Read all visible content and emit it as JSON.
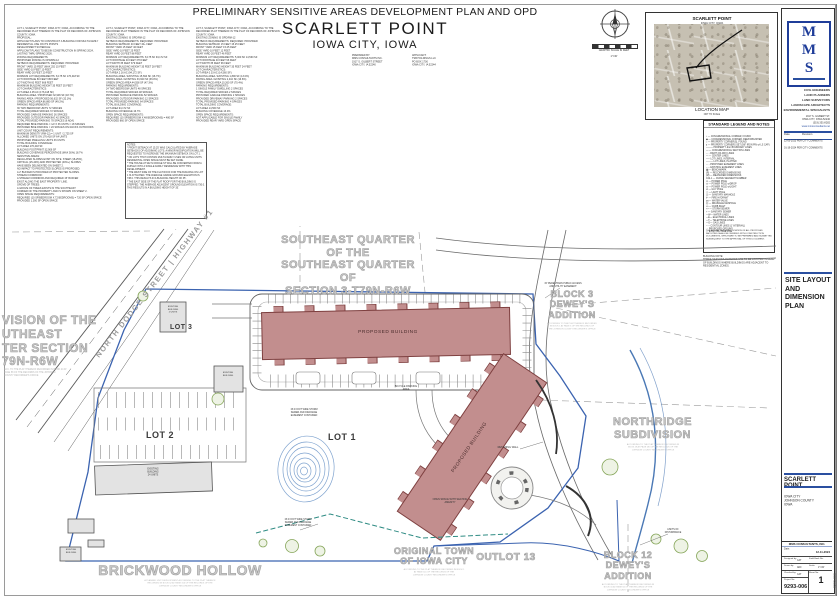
{
  "sheet": {
    "main_title": "PRELIMINARY SENSITIVE AREAS DEVELOPMENT PLAN AND OPD",
    "project_name": "SCARLETT POINT",
    "project_city": "IOWA CITY, IOWA"
  },
  "header": {
    "legal_block_1": "LOT 1, SCARLETT POINT, IOWA CITY, IOWA, ACCORDING TO THE RECORDED PLAT THEREOF IN THE PLAT OF RECORDS OF JOHNSON COUNTY, IOWA.\nPROPOSAL:\nAPPLICANT PLANS TO CONSTRUCT A BUILDING FOR MULTI-FAMILY RESIDENTIAL USE ON ITS POINTS\nDEVELOPMENT SCHEDULE:\nAPPLICANT PLANS TO BEGIN CONSTRUCTION IN SPRING 2024, LASTING THRU SPRING 2026.\nZONING REQUIREMENTS:\nPROPOSED ZONING IS OPD/RM-12\nSETBACK REQUIREMENTS:   REQUIRED:   PROVIDED:\nFRONT YARD   15 FEET (MAX 25')   15 FEET\nSIDE YARD   10 FEET   10 FEET\nREAR YARD   20 FEET   20 FEET\nMINIMUM LOT REQUIREMENTS:   8,175 SF   176,418 SF\nLOT FRONTAGE   80 FEET   668 FEET\nLOT WIDTH   60 FEET   668 FEET\nMAXIMUM BUILDING HEIGHT   35 FEET   35 FEET\nLOT CHARACTERISTICS:\nLOT AREA   4.05 AC (176,418 SF)\nBUILDING AREA / PROPOSED   32,906 SF (18.7%)\nPAVING AREA / PROPOSED   56,632 SF (32.1%)\nGREEN SPACE AREA   86,880 SF (49.2%)\nPARKING REQUIREMENTS:\n36 TWO BEDROOM UNITS   72 SPACES\nTOTAL REQUIRED SPACES   72 SPACES\nPROVIDED GARAGE PARKING   36 SPACES\nPROVIDED OUTDOOR PARKING   42 SPACES\nTOTAL PROVIDED PARKING   78 SPACES (6 ADA)\nREQUIRED BIKE PARKING = 1/2 X 36 UNITS = 18 SPACES\nPROVIDED BIKE PARKING = 20 SPACES ON RACKS OUTDOORS\nUNIT COUNT REQUIREMENTS:\nMAXIMUM DENSITY (RM-12) = 1 UNIT / 2,725 SF\nALLOWED UNITS ON 176,418 SF   64 UNITS\nPROPOSED DWELLING UNITS   36 UNITS\nTOTAL BUILDING COVERAGE:\nLOT AREA   176,418 SF\nBUILDING FOOTPRINT   32,906 SF\nBUILDING COVERAGE PERCENTAGE (MAX 50%)   18.7%\nSENSITIVE AREAS:\nREGULATED SLOPES EXIST ON SITE. STEEP (18-25%),\nCRITICAL (25-40%) AND PROTECTED (40%+) SLOPES\nHAVE BEEN DELINEATED ON SHEET 2.\nNO IMPACT TO PROTECTED SLOPES IS PROPOSED.\nA 2' BUFFER IS PROVIDED AT PROTECTED SLOPES.\nSTREAM CORRIDOR:\nA STREAM CORRIDOR AND REQUIRED 15' BUFFER\nEXIST ALONG THE EAST PROPERTY LINE.\nGROVE OF TREES:\nA GROVE OF TREES EXISTS IN THE SOUTHEAST\nCORNER OF THE PROPERTY AND IS SHOWN ON SHEET 2.\nOPEN SPACE REQUIREMENTS:\nREQUIRED (10 SF/BEDROOM X 72 BEDROOMS) = 720 SF OPEN SPACE\nPROVIDED   1,300 SF OPEN SPACE",
    "legal_block_2": "LOT 2, SCARLETT POINT, IOWA CITY, IOWA, ACCORDING TO THE RECORDED PLAT THEREOF IN THE PLAT OF RECORDS OF JOHNSON COUNTY, IOWA.\nEXISTING ZONING IS OPD/RM-12\nSETBACK REQUIREMENTS:   REQUIRED:   PROVIDED:\nBUILDING SETBACK   40 FEET   40+ FEET\nFRONT YARD   15 FEET   40 FEET\nSIDE YARD   10 FEET   25 FEET\nREAR YARD   20 FEET   88 FEET\nMINIMUM LOT REQUIREMENTS:   8,175 SF   94,172 SF\nLOT FRONTAGE   40 FEET   379 FEET\nLOT WIDTH   35 FEET   379 FEET\nMAXIMUM BUILDING HEIGHT   35 FEET   28 FEET\nLOT CHARACTERISTICS:\nLOT AREA   2.16 AC (94,172 SF)\nBUILDING AREA / EXISTING   15,694 SF (16.7%)\nPAVING AREA / EXISTING   33,920 SF (36.0%)\nGREEN SPACE AREA   44,558 SF (47.3%)\nPARKING REQUIREMENTS:\n24 TWO BEDROOM UNITS   48 SPACES\nTOTAL REQUIRED SPACES   48 SPACES\nPROVIDED SURFACE PARKING   52 SPACES\nPROVIDED OUTDOOR PARKING   12 SPACES\nTOTAL PROVIDED PARKING   64 SPACES\nTOTAL BUILDING COVERAGE:\nLOT AREA   94,172 SF\nBUILDING COVERAGE   16.7%\nOPEN SPACE REQUIREMENTS:\nREQUIRED (10 SF/BEDROOM X 48 BEDROOMS) = 480 SF\nPROVIDED   860 SF OPEN SPACE",
    "legal_block_3": "LOT 3, SCARLETT POINT, IOWA CITY, IOWA, ACCORDING TO THE RECORDED PLAT THEREOF IN THE PLAT OF RECORDS OF JOHNSON COUNTY, IOWA.\nEXISTING ZONING IS OPD/RM-12\nSETBACK REQUIREMENTS:   REQUIRED:   PROVIDED:\nBUILDING SETBACK   15 FEET   15.25 FEET\nFRONT YARD   15 FEET   15.25 FEET\nSIDE YARD   10 FEET   12 FEET\nREAR YARD   20 FEET   46 FEET\nMINIMUM LOT REQUIREMENTS:   5,000 SF   14,560 SF\nLOT FRONTAGE   40 FEET   96 FEET\nLOT WIDTH   35 FEET   96 FEET\nMAXIMUM BUILDING HEIGHT   35 FEET   24 FEET\nLOT CHARACTERISTICS:\nLOT AREA   0.33 AC (14,560 SF)\nBUILDING AREA / EXISTING   1,890 SF (13.0%)\nPAVING AREA / EXISTING   2,410 SF (16.6%)\nGREEN SPACE AREA   10,260 SF (70.4%)\nPARKING REQUIREMENTS:\n1 SINGLE FAMILY DWELLING   2 SPACES\nTOTAL REQUIRED SPACES   2 SPACES\nPROVIDED GARAGE PARKING   2 SPACES\nPROVIDED DRIVEWAY PARKING   2 SPACES\nTOTAL PROVIDED PARKING   4 SPACES\nTOTAL BUILDING COVERAGE:\nLOT AREA   14,560 SF\nBUILDING COVERAGE   13.0%\nOPEN SPACE REQUIREMENTS:\nNOT APPLICABLE FOR SINGLE FAMILY\nPROVIDED   REAR YARD OPEN SPACE",
    "notes_box": "NOTES:\n* FRONT SETBACK AT 15.25' WAS CALCULATED BY AVERAGE SETBACKS OF ADJOINING LOTS. A MINOR MODIFICATION WILL BE REQUESTED TO INCREASE THE MAXIMUM SETBACK ON LOT 1.\n* ON LOTS THAT CONTAIN MULTI-FAMILY USES OR LIVING UNITS RESIDENTIAL OPEN SPACE MUST BE SET ASIDE.\n* THE HOUSE AT 902 N DODGE ST WILL BE CONVERTED FROM A DUPLEX INTO A SINGLE FAMILY RESIDENCE WITH THIS DEVELOPMENT.\n* THE WEST SIDE OF THE FLAT ROOF FOR THE BUILDING ON LOT 1 IS ATTACHED. THE AVERAGE GRADE GROUND ELEVATION IS 738.0. THIS RESULTS IN A BUILDING HEIGHT OF 35'.\n* THE EAST SIDE OF THE FLAT ROOF FOR THE BUILDING IS STEPPED. THE AVERAGE ADJACENT GROUND ELEVATION IS 730.0. THIS RESULTS IN A BUILDING HEIGHT OF 35'.",
    "prepared_by": "PREPARED BY:\nMMS CONSULTANTS INC.\n1917 S. GILBERT STREET\nIOWA CITY, IA 52240",
    "applicant": "APPLICANT:\nTSB HOLDINGS LLC\nPO BOX 1700\nIOWA CITY, IA 52244",
    "graphic_scale_caption": "GRAPHIC SCALE IN FEET",
    "graphic_scale_value": "1\"=30'"
  },
  "location_map": {
    "callout_title": "SCARLETT POINT",
    "callout_sub": "IOWA CITY, IOWA",
    "caption": "LOCATION MAP",
    "caption_sub": "NOT TO SCALE"
  },
  "legend": {
    "title": "STANDARD LEGEND AND NOTES",
    "items": "⌖ — CONGRESSIONAL CORNER, FOUND\n◆ — CONGRESSIONAL CORNER, REESTABLISHED\n○ — PROPERTY CORNER(S), FOUND\n● — PROPERTY CORNERS SET (5/8\" IRON PIN w/ LS CAP)\n——— PROPERTY &/or BOUNDARY LINES\n—·— CONGRESSIONAL SECTION LINES\n- - - RIGHT-OF-WAY LINES\n— — CENTER LINES\n––– LOT LINES, INTERNAL\n——— LOT LINES, PLATTED\n- - - PROPOSED EASEMENT LINES\n-- -- EXISTING EASEMENT LINES\n▣ — BENCHMARK\n(R) — RECORDED DIMENSIONS\n(M) — MEASURED DIMENSIONS\nC22-1 — CURVE SEGMENT NUMBER\n⊙ — POWER POLE\n⊙ — POWER POLE w/DROP\n⊙ — POWER POLE w/LIGHT\n⊘ — GUY POLE\n☆ — LIGHT POLE\nⓈ — SANITARY MANHOLE\n⊩ — FIRE HYDRANT\n⋈ — WATER VALVE\nⒹ — DRAINAGE MANHOLE\n▭ — CURB INLET\n>> — STORM SEWER\n> — SANITARY SEWER\n—W— WATER LINES\n—E— ELECTRICAL LINES\n—T— TELEPHONE LINES\n—G— GAS LINES\n─ ─ CONTOUR LINES (1' INTERVAL)\n··· PROPOSED GROUND\n〰 EXISTING TREE LINE",
    "footnote": "THE ACTUAL SIZE AND LOCATION OF ALL PROPOSED FACILITIES SHALL BE VERIFIED WITH CONSTRUCTION DOCUMENTS, WHICH ARE TO BE PREPARED AND SUBMITTED SUBSEQUENT TO THE APPROVAL OF THIS DOCUMENT.",
    "building_note": "BUILDING NOTE:\nTHREE-SEASONS PORCHES ARE TO BE LOCATED IN REAR OF BUILDINGS WHERE BUILDINGS ARE ADJACENT TO RESIDENTIAL ZONES."
  },
  "firm_panel": {
    "logo_letters": [
      "M",
      "M",
      "S"
    ],
    "disciplines": [
      "CIVIL ENGINEERS",
      "LAND PLANNERS",
      "LAND SURVEYORS",
      "LANDSCAPE ARCHITECTS",
      "ENVIRONMENTAL SPECIALISTS"
    ],
    "address": "1917 S. GILBERT ST.\nIOWA CITY, IOWA 52240\n(319) 351-8282",
    "website": "www.mmsconsultants.net",
    "revisions": {
      "col_date": "Date",
      "col_revision": "Revision",
      "rows": [
        "12-05-2023  PER CITY COMMENTS",
        "01-19-2024  PER CITY COMMENTS"
      ]
    },
    "sheet_title": "SITE LAYOUT\nAND DIMENSION\nPLAN",
    "project_name": "SCARLETT POINT",
    "project_location": "IOWA CITY\nJOHNSON COUNTY\nIOWA",
    "firm_name": "MMS CONSULTANTS, INC.",
    "date_label": "Date:",
    "date_value": "12-11-2024",
    "fields": {
      "designed_by_label": "Designed by:",
      "designed_by": "CAT",
      "drawn_by_label": "Drawn by:",
      "drawn_by": "ADF",
      "checked_by_label": "Checked by:",
      "checked_by": "CAT",
      "field_book_label": "Field Book No:",
      "field_book": "",
      "scale_label": "Scale:",
      "scale": "1\"=30'",
      "sheet_label": "Sheet No:",
      "sheet_no": "1",
      "project_label": "Project No:",
      "project_no": "9293-006"
    },
    "edge_text": "9293-006"
  },
  "plan": {
    "street_label": "NORTH DODGE STREET | HIGHWAY #1",
    "labels": {
      "se_quarter": "SOUTHEAST QUARTER\nOF THE\nSOUTHEAST QUARTER\nOF\nSECTION 3-T79N-R6W",
      "west_plat": "VISION OF THE\nUTHEAST\nTER SECTION\n79N-R6W",
      "west_plat_note": "ACC. TO THE PLAT THEREOF RECORDED IN BOOK 24 AT\nPAGE 58 OF THE RECORDS OF THE JOHNSON\nCOUNTY RECORDER'S OFFICE",
      "block3": "BLOCK 3\nDEWEY'S\nADDITION",
      "block3_note": "ACCORDING TO THE PLAT THEREOF RECORDED\nIN BOOK 1 AT PAGE 5 OF THE RECORDS OF\nTHE JOHNSON COUNTY RECORDER'S OFFICE",
      "northridge": "NORTHRIDGE\nSUBDIVISION",
      "northridge_note": "ACCORDING TO THE PLAT THEREOF RECORDED IN\nBOOK 29 AT PAGE 283 OF THE RECORDS OF THE\nJOHNSON COUNTY RECORDER'S OFFICE",
      "brickwood": "BRICKWOOD HOLLOW",
      "brickwood_note": "A PLANNED UNIT DEVELOPMENT ACCORDING TO THE PLAT THEREOF\nRECORDED IN BOOK 62 AT PAGE 316 OF THE RECORDS OF THE\nJOHNSON COUNTY RECORDER'S OFFICE",
      "original_town": "ORIGINAL TOWN\nOF IOWA CITY",
      "original_town_note": "ACCORDING TO THE PLAT THEREOF RECORDED IN BOOK 1\nAT PAGE 116 OF THE RECORDS OF THE\nJOHNSON COUNTY RECORDER'S OFFICE",
      "outlot": "OUTLOT 13",
      "block12": "BLOCK 12\nDEWEY'S\nADDITION",
      "block12_note": "ACCORDING TO THE PLAT THEREOF RECORDED IN\nBOOK 16 AT PAGE 84 OF THE RECORDS OF THE\nJOHNSON COUNTY RECORDER'S OFFICE",
      "lot1": "LOT 1",
      "lot2": "LOT 2",
      "lot3": "LOT 3"
    },
    "buildings": {
      "proposed_label": "PROPOSED BUILDING",
      "existing_label": "EXISTING\nBUILDING",
      "existing_lot2_label": "EXISTING\nBUILDING\n24 UNITS",
      "existing_lot3_label": "EXISTING\nBUILDING\n2 UNITS"
    },
    "annotations": {
      "retaining_wall": "RETAINING WALL",
      "bike_parking": "BICYCLE PARKING\nAREA",
      "plaza": "OPEN SPACE WITH SEATING\nAMENITY",
      "storm_easement": "15.0 FOOT WIDE STORM\nSEWER AND DRAINAGE\nEASEMENT CONTAINED",
      "access_easement": "15' PEDESTRIAN PUBLIC ACCESS\nAND UTILITY EASEMENT",
      "limits": "LIMITS OF\nDISTURBANCE"
    }
  },
  "colors": {
    "building_fill": "#c28e8e",
    "building_stroke": "#7e4040",
    "boundary_blue": "#3b63b0",
    "water_blue": "#7fa3cf",
    "utility_teal": "#2e8b83",
    "tree_green": "#86a65a",
    "area_label_gray": "#c9c9c9",
    "accent_blue": "#2a4fa0",
    "logo_blue": "#1f3d99"
  }
}
